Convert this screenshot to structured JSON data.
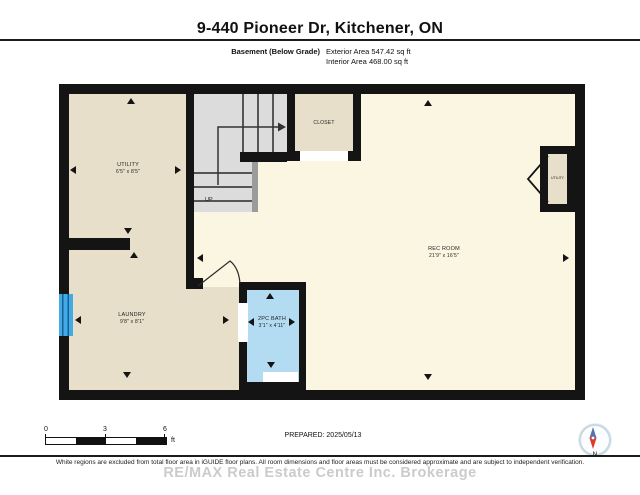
{
  "header": {
    "title": "9-440 Pioneer Dr, Kitchener, ON"
  },
  "subheader": {
    "floor_label": "Basement (Below Grade)",
    "exterior_area": "Exterior Area 547.42 sq ft",
    "interior_area": "Interior Area 468.00 sq ft"
  },
  "plan": {
    "rooms": [
      {
        "id": "utility-left",
        "name": "UTILITY",
        "dims": "6'5\" x 8'5\""
      },
      {
        "id": "laundry",
        "name": "LAUNDRY",
        "dims": "9'8\" x 8'1\""
      },
      {
        "id": "rec-room",
        "name": "REC ROOM",
        "dims": "21'9\" x 16'5\""
      },
      {
        "id": "bath",
        "name": "2PC BATH",
        "dims": "3'1\" x 4'11\""
      },
      {
        "id": "closet",
        "name": "CLOSET",
        "dims": ""
      },
      {
        "id": "utility-right",
        "name": "UTILITY",
        "dims": ""
      }
    ],
    "stairs_label": "UP"
  },
  "scale_bar": {
    "labels": [
      "0",
      "3",
      "6"
    ],
    "unit": "ft"
  },
  "footer": {
    "prepared": "PREPARED: 2025/05/13",
    "compass_label": "N",
    "watermark": "RE/MAX Real Estate Centre Inc. Brokerage",
    "disclaimer": "White regions are excluded from total floor area in iGUIDE floor plans. All room dimensions and floor areas must be considered approximate and are subject to independent verification."
  },
  "colors": {
    "wall": "#141414",
    "room_beige": "#e7dfca",
    "room_cream": "#fbf6e2",
    "bath_blue": "#b3dcf2",
    "window_blue": "#42abe5",
    "stairs_gray": "#dcdcdc",
    "compass_red": "#e0392b",
    "compass_blue": "#5b6fae"
  }
}
